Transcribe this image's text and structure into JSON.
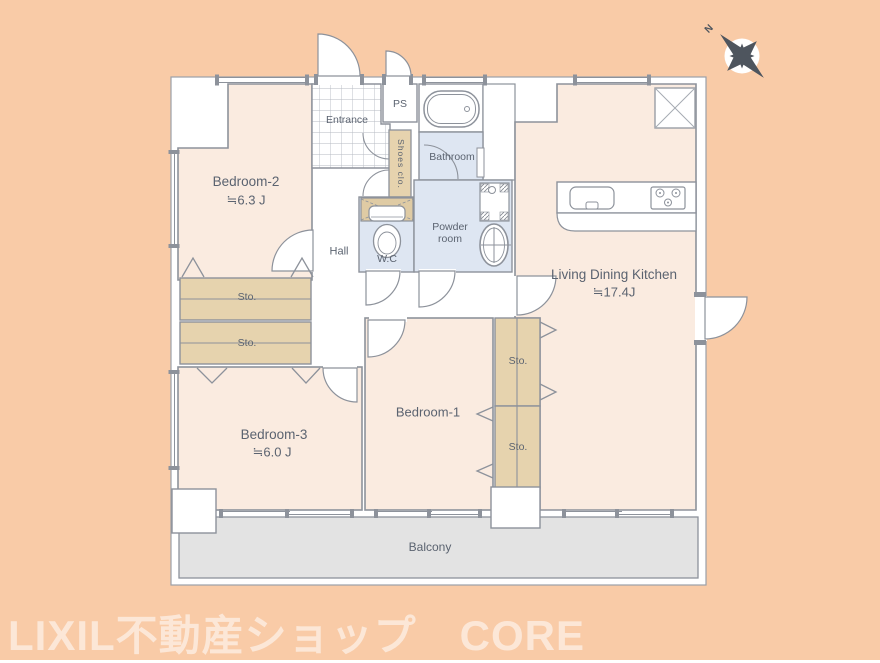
{
  "watermark": {
    "text": "LIXIL不動産ショップ　CORE"
  },
  "compass": {
    "north_label": "N"
  },
  "rooms": {
    "bedroom2": {
      "name": "Bedroom-2",
      "area": "≒6.3 J"
    },
    "bedroom3": {
      "name": "Bedroom-3",
      "area": "≒6.0 J"
    },
    "bedroom1": {
      "name": "Bedroom-1"
    },
    "ldk": {
      "name": "Living Dining Kitchen",
      "area": "≒17.4J"
    },
    "hall": {
      "name": "Hall"
    },
    "entrance": {
      "name": "Entrance"
    },
    "ps": {
      "name": "PS"
    },
    "bathroom": {
      "name": "Bathroom"
    },
    "powder_room": {
      "name": "Powder room"
    },
    "wc": {
      "name": "W.C"
    },
    "shoes_closet": {
      "name": "Shoes clo."
    },
    "balcony": {
      "name": "Balcony"
    },
    "storage": {
      "name": "Sto."
    }
  },
  "colors": {
    "background": "#F9CBA7",
    "room_fill": "#FAEBE0",
    "wet_room_fill": "#DEE6F2",
    "storage_fill": "#E6D3AE",
    "closet_shelf_fill": "#DFCBA4",
    "balcony_fill": "#E3E3E3",
    "wall": "#8D929B",
    "label_text": "#5B6370",
    "compass": "#4E555E",
    "watermark_text": "rgba(255,255,255,0.55)"
  }
}
